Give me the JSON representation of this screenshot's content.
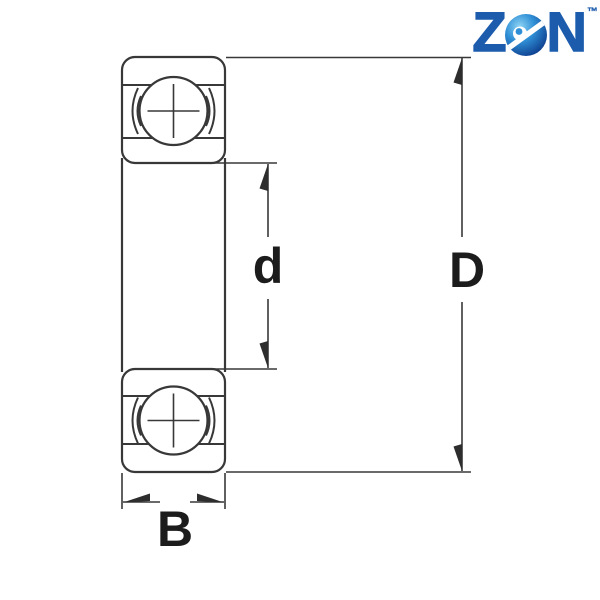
{
  "brand": {
    "name": "ZEN",
    "letter_z": "Z",
    "letter_n": "N",
    "trademark": "™",
    "letter_color": "#1d5cad",
    "globe_gradient": [
      "#8ed4f4",
      "#2f8fd6",
      "#0c3a8a"
    ],
    "swoosh_color": "#ffffff"
  },
  "diagram": {
    "type": "deep-groove-ball-bearing-cross-section",
    "line_color": "#383838",
    "label_color": "#1c1c1c",
    "dimensions": {
      "bore_diameter": {
        "label": "d"
      },
      "outer_diameter": {
        "label": "D"
      },
      "width": {
        "label": "B"
      }
    }
  }
}
